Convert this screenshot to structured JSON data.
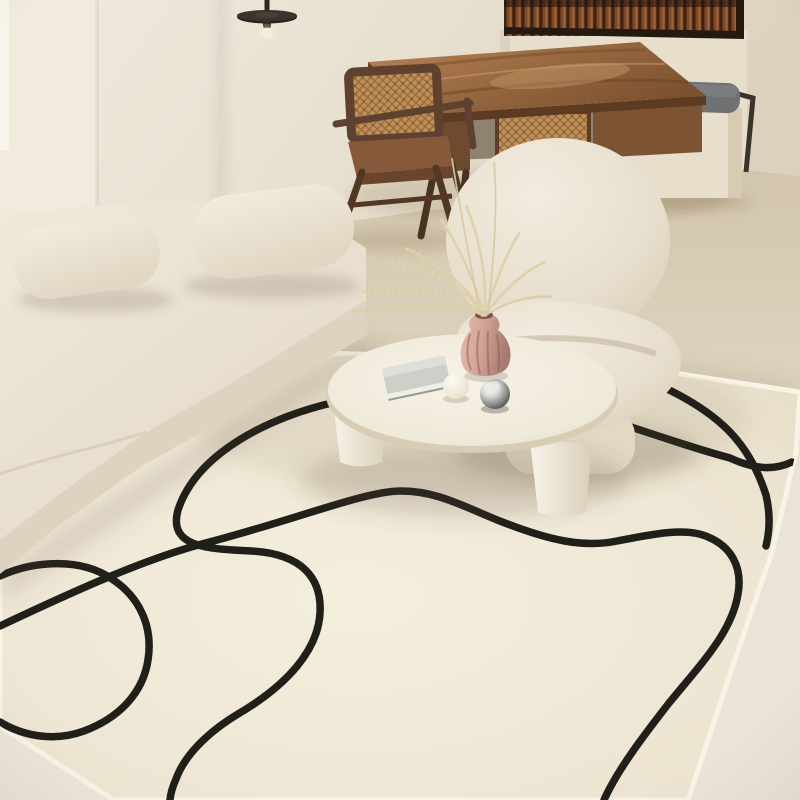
{
  "scene": {
    "type": "interior photograph",
    "setting": "minimalist cream japandi living room",
    "objects": [
      {
        "name": "area-rug",
        "description": "large cream rug with abstract black continuous-line loop pattern"
      },
      {
        "name": "modular-sofa",
        "description": "low cream boucle modular sofa with two rounded back bolsters"
      },
      {
        "name": "lounge-chair",
        "description": "puffy rounded cream boucle lounge chair"
      },
      {
        "name": "coffee-table",
        "description": "round cream stone coffee table with chunky splayed legs"
      },
      {
        "name": "writing-desk",
        "description": "live-edge walnut desk with woven cane drawer front"
      },
      {
        "name": "desk-chair",
        "description": "walnut chair with woven cane backrest and compass legs"
      },
      {
        "name": "window-bench",
        "description": "cream bench cube with slate gray cushion and dark metal frame"
      },
      {
        "name": "half-wall-partition",
        "description": "cream half wall topped with fluted walnut slat screen"
      },
      {
        "name": "pendant-lamp",
        "description": "black disc pendant lamp with exposed bulb"
      },
      {
        "name": "vase",
        "description": "ribbed blush pink vase holding dried pampas grass"
      },
      {
        "name": "book",
        "description": "gray hardcover book lying on the tabletop"
      },
      {
        "name": "decor-spheres",
        "description": "matte white sphere and chrome sphere on the tabletop"
      }
    ]
  },
  "palette": {
    "wall": "#e8e0d1",
    "wallPanel": "#f1ebde",
    "floor": "#e0d6c2",
    "floorLight": "#eae4d8",
    "partition": "#e7dfcc",
    "benchCushion": "#6f7173",
    "benchBase": "#e7decb",
    "rug": "#f0e9d8",
    "rugFringe": "#f8f3e5",
    "rugLine": "#201f1a",
    "sofa": "#ece4d4",
    "sofaShadow": "#ded3c0",
    "armchair": "#ece5d6",
    "tableTop": "#f4efe2",
    "deskWood": "#996a41",
    "caneWeave": "#c0905a",
    "slatWood": "#7c4a28",
    "chairWood": "#5f4130",
    "pendant": "#27241f",
    "vasePink": "#d2a296",
    "pampas": "#ddcfa9",
    "bookCover": "#cfcfca",
    "bookPages": "#efefe9",
    "whiteSphere": "#fcf9f1",
    "chromeSphere": "#8b8b89",
    "seam": "#d9cdb9"
  }
}
